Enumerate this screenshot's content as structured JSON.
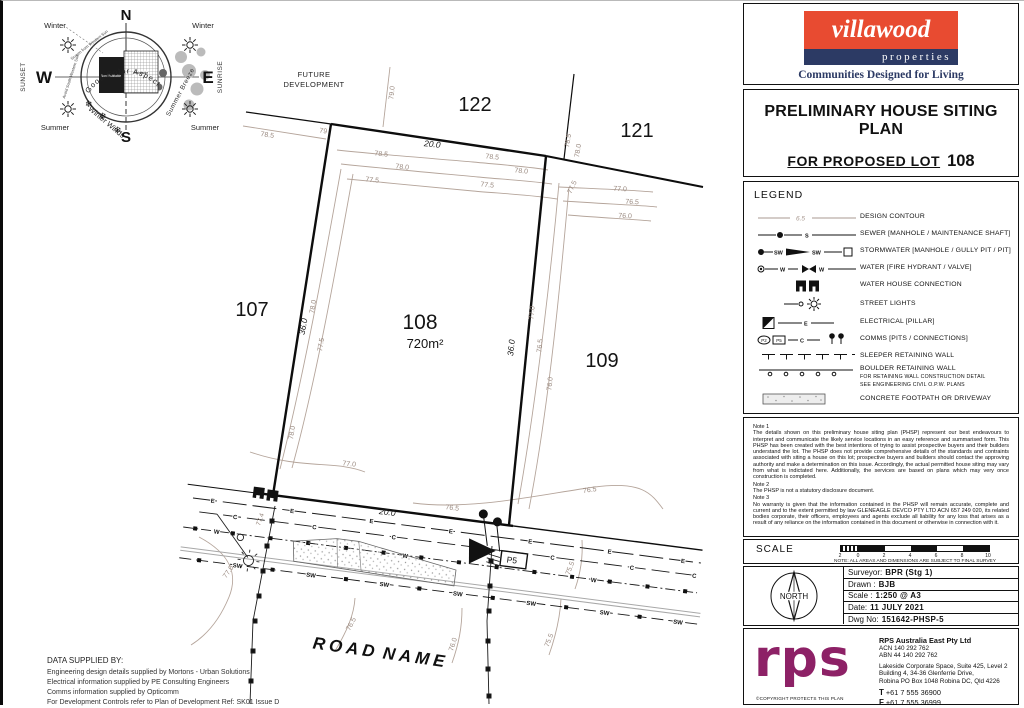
{
  "header": {
    "brand": "villawood",
    "brand_sub": "properties",
    "tagline": "Communities Designed for Living"
  },
  "title_block": {
    "title": "PRELIMINARY HOUSE SITING PLAN",
    "subtitle": "FOR PROPOSED LOT",
    "lot_no": "108",
    "location": "Situated at Eucalee in the locality of Gleneagle"
  },
  "legend": {
    "heading": "LEGEND",
    "sym": {
      "contour": "6.5",
      "s": "S",
      "sw": "SW",
      "w": "W",
      "e": "E",
      "c": "C",
      "p2": "P2",
      "p5": "P5"
    },
    "items": [
      {
        "label": "DESIGN CONTOUR"
      },
      {
        "label": "SEWER  [MANHOLE / MAINTENANCE SHAFT]"
      },
      {
        "label": "STORMWATER  [MANHOLE / GULLY PIT / PIT]"
      },
      {
        "label": "WATER  [FIRE HYDRANT / VALVE]"
      },
      {
        "label": "WATER HOUSE CONNECTION"
      },
      {
        "label": "STREET LIGHTS"
      },
      {
        "label": "ELECTRICAL [PILLAR]"
      },
      {
        "label": "COMMS [PITS / CONNECTIONS]"
      },
      {
        "label": "SLEEPER RETAINING WALL"
      },
      {
        "label": "BOULDER RETAINING WALL",
        "sub1": "FOR RETAINING WALL CONSTRUCTION DETAIL",
        "sub2": "SEE ENGINEERING CIVIL O.P.W. PLANS"
      },
      {
        "label": "CONCRETE FOOTPATH OR DRIVEWAY"
      }
    ]
  },
  "notes": {
    "n1_title": "Note 1",
    "n1": "The details shown on this preliminary house siting plan (PHSP) represent our best endeavours to interpret and communicate the likely service locations in an easy reference and summarised form. This PHSP has been created with the best intentions of trying to assist prospective buyers and their builders understand the lot. The PHSP does not provide comprehensive details of the standards and contraints associated with siting a house on this lot; prospective buyers and builders should contact the approving authority and make a determination on this issue. Accordingly, the actual permitted house siting may vary from what is indictated here. Additionally, the services are based on plans which may very once construction is completed.",
    "n2_title": "Note 2",
    "n2": "The PHSP is not a statutory disclosure document.",
    "n3_title": "Note 3",
    "n3": "No warranty is given that the information contained in the PHSP will remain accurate, complete and current and to the extent permitted by law GLENEAGLE DEVCO PTY LTD  ACN 657 249 020, its related bodies corporate, their officers, employees and agents exclude all liability for any loss that arises as a result of any reliance on the information contained in this document or otherwise in connection with it.",
    "scale_label": "SCALE",
    "scale_ticks": [
      "2",
      "0",
      "2",
      "4",
      "6",
      "8",
      "10"
    ],
    "scale_note_label": "NOTE:",
    "scale_note": "ALL AREAS AND DIMENSIONS ARE SUBJECT TO FINAL SURVEY"
  },
  "titleblock": {
    "north": "NORTH",
    "rows": [
      {
        "label": "Surveyor:",
        "value": "BPR (Stg 1)"
      },
      {
        "label": "Drawn :",
        "value": "BJB"
      },
      {
        "label": "Scale :",
        "value": "1:250 @ A3"
      },
      {
        "label": "Date:",
        "value": "11 JULY 2021"
      },
      {
        "label": "Dwg No:",
        "value": "151642-PHSP-5"
      }
    ]
  },
  "firm": {
    "logo": "rps",
    "name": "RPS Australia East Pty Ltd",
    "acn": "ACN 140 292 762",
    "abn": "ABN 44 140 292 762",
    "addr1": "Lakeside Corporate Space, Suite 425, Level 2",
    "addr2": "Building 4, 34-36 Glenferrie Drive,",
    "addr3": "Robina PO Box 1048 Robina DC, Qld 4226",
    "t_label": "T",
    "t": "+61 7 555 36900",
    "f_label": "F",
    "f": "+61 7 555 36999",
    "copyright": "©COPYRIGHT PROTECTS THIS PLAN"
  },
  "footer": {
    "heading": "DATA SUPPLIED BY:",
    "line1": "Engineering design details supplied by  Mortons - Urban Solutions",
    "line2": "Electrical information supplied by PE Consulting Engineers",
    "line3": "Comms information supplied by Opticomm",
    "line4": "For Development Controls refer to Plan of Development Ref: SK01 Issue D"
  },
  "compass": {
    "n": "N",
    "s": "S",
    "e": "E",
    "w": "W",
    "arc": "Good  Solar  Aspect",
    "winter": "Winter",
    "summer": "Summer",
    "sunset": "SUNSET",
    "sunrise": "SUNRISE",
    "winter_winds": "Winter Winds",
    "summer_breeze": "Summer Breeze",
    "non_habitable": "Non Habitable",
    "habitable": "Habitable",
    "screen": "Screen from Western Sun",
    "avoid": "Avoid South Western Sun",
    "flake": "❄"
  },
  "plan": {
    "future_development_1": "FUTURE",
    "future_development_2": "DEVELOPMENT",
    "road_1": "ROAD",
    "road_2": "NAME",
    "lots": {
      "l122": "122",
      "l121": "121",
      "l107": "107",
      "l108": "108",
      "l109": "109"
    },
    "area_108": "720m²",
    "dims": {
      "top": "20.0",
      "front": "20.0",
      "side": "36.0"
    },
    "svc": {
      "e": "E",
      "c": "C",
      "w": "W",
      "sw": "SW",
      "s": "S",
      "p5": "P5"
    },
    "contours": {
      "c790": "79.0",
      "c79": "79",
      "c785": "78.5",
      "c780": "78.0",
      "c775": "77.5",
      "c770": "77.0",
      "c765": "76.5",
      "c760": "76.0",
      "c755": "75.5",
      "c774": "77.4"
    }
  }
}
